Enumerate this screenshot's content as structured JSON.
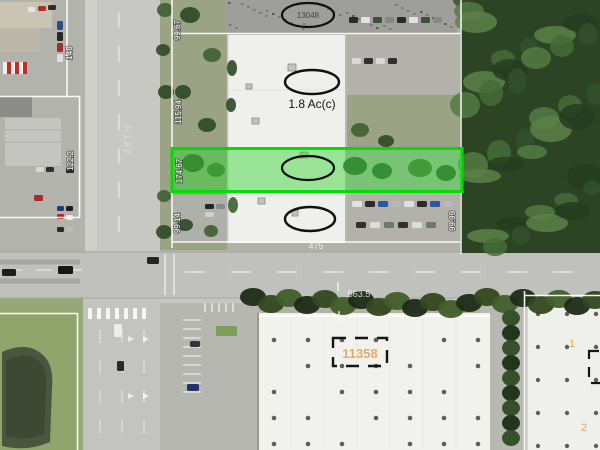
{
  "map": {
    "street": {
      "label": "28TH"
    },
    "labels": {
      "area_acres": "1.8 Ac(c)",
      "top_parcel_number": "13048",
      "bottom_parcel_number": "11358",
      "bottom_width": "563.5",
      "width_475": "475",
      "unit_marker_1": "1",
      "unit_marker_2": "2"
    },
    "dimensions": {
      "left_top": "99.67",
      "left_mid": "115.94",
      "left_green": "174.67",
      "left_bottom": "99.14",
      "right": "99.99",
      "nw_top": "148",
      "nw_bottom": "122.2"
    },
    "colors": {
      "highlight_border": "#00dd00",
      "highlight_fill": "rgba(50,215,50,0.45)",
      "parcel_line": "#ffffff",
      "parcel_number_orange": "#dfa24e"
    }
  }
}
